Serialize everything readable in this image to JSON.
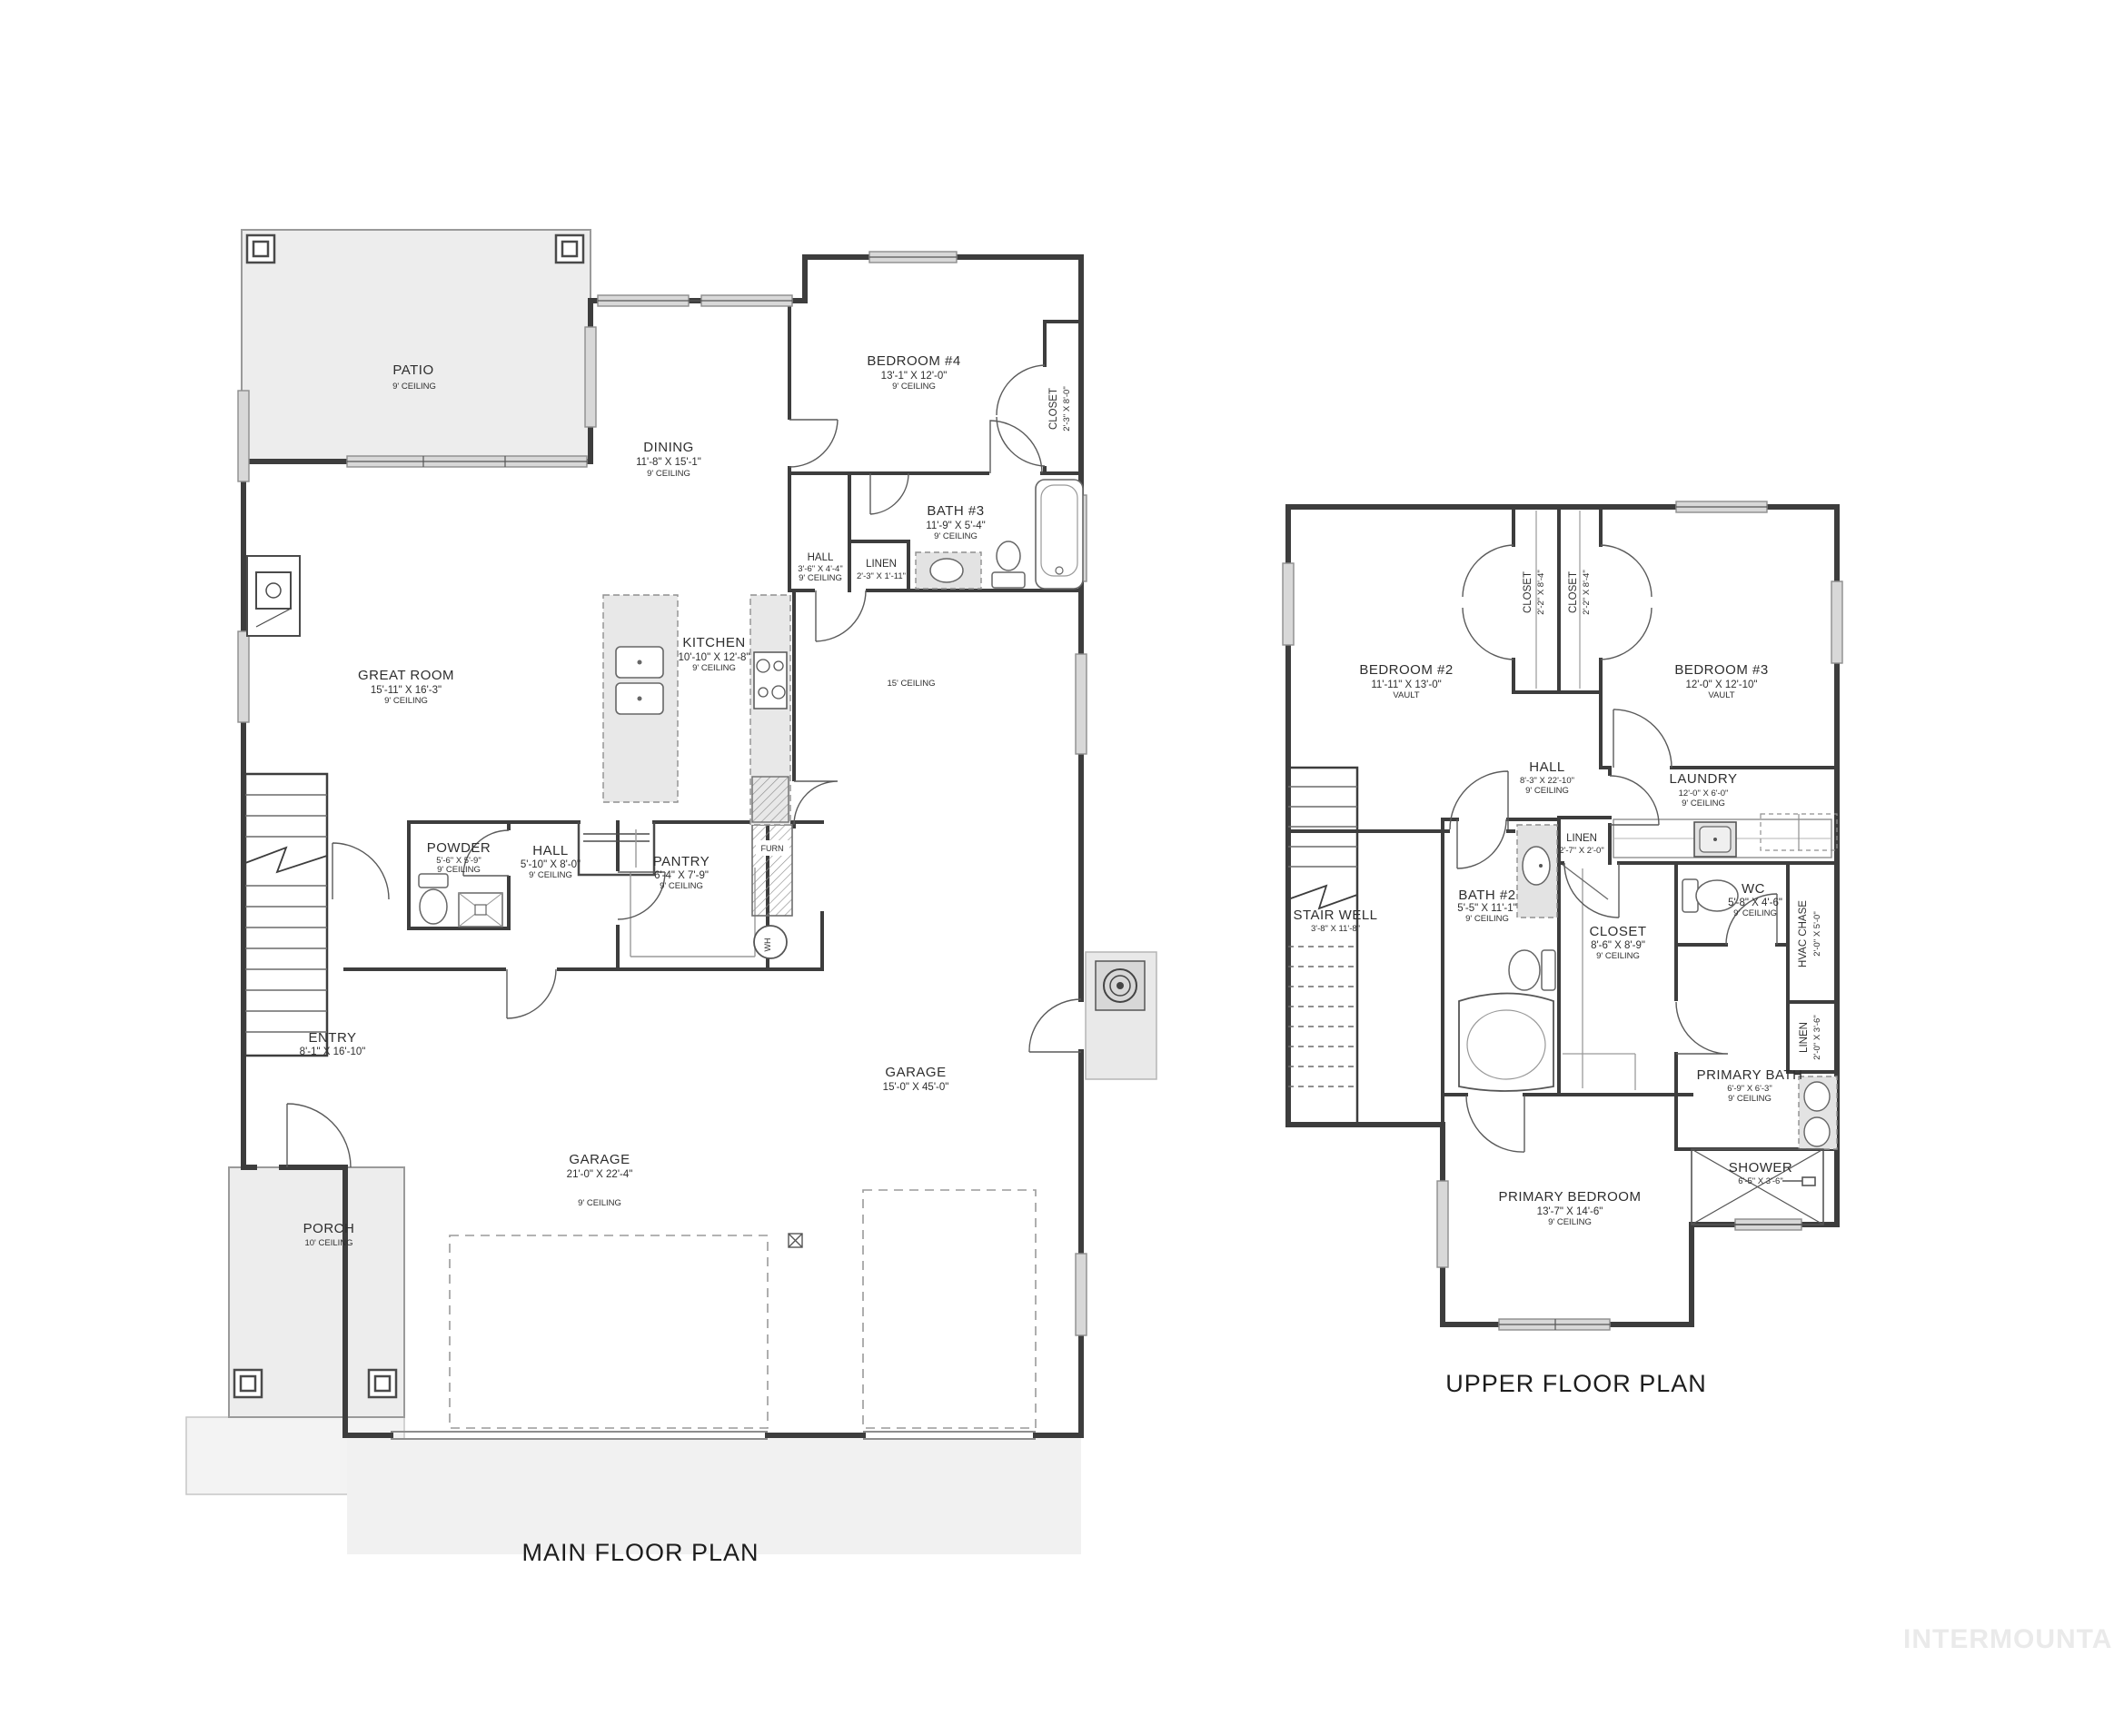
{
  "watermark": "INTERMOUNTAIN",
  "main": {
    "title": "MAIN FLOOR PLAN",
    "rooms": {
      "patio": {
        "name": "PATIO",
        "ceiling": "9' CEILING"
      },
      "dining": {
        "name": "DINING",
        "dims": "11'-8\" X 15'-1\"",
        "ceiling": "9' CEILING"
      },
      "bedroom4": {
        "name": "BEDROOM #4",
        "dims": "13'-1\" X 12'-0\"",
        "ceiling": "9' CEILING"
      },
      "closet4": {
        "name": "CLOSET",
        "dims": "2'-3\" X 8'-0\""
      },
      "bath3": {
        "name": "BATH #3",
        "dims": "11'-9\" X 5'-4\"",
        "ceiling": "9' CEILING"
      },
      "hall_bed": {
        "name": "HALL",
        "dims": "3'-6\" X 4'-4\"",
        "ceiling": "9' CEILING"
      },
      "linen": {
        "name": "LINEN",
        "dims": "2'-3\" X 1'-11\""
      },
      "great_room": {
        "name": "GREAT ROOM",
        "dims": "15'-11\" X 16'-3\"",
        "ceiling": "9' CEILING"
      },
      "kitchen": {
        "name": "KITCHEN",
        "dims": "10'-10\" X 12'-8\"",
        "ceiling": "9' CEILING"
      },
      "open_area": {
        "ceiling": "15' CEILING"
      },
      "powder": {
        "name": "POWDER",
        "dims": "5'-6\" X 5'-9\"",
        "ceiling": "9' CEILING"
      },
      "hall": {
        "name": "HALL",
        "dims": "5'-10\" X 8'-0\"",
        "ceiling": "9' CEILING"
      },
      "pantry": {
        "name": "PANTRY",
        "dims": "6'-4\" X 7'-9\"",
        "ceiling": "9' CEILING"
      },
      "furnace": {
        "name": "FURN"
      },
      "water_heater": {
        "name": "WH"
      },
      "entry": {
        "name": "ENTRY",
        "dims": "8'-1\" X 16'-10\""
      },
      "garage": {
        "name": "GARAGE",
        "dims": "21'-0\" X 22'-4\"",
        "ceiling": "9' CEILING"
      },
      "rv_garage": {
        "name": "GARAGE",
        "dims": "15'-0\" X 45'-0\""
      },
      "porch": {
        "name": "PORCH",
        "ceiling": "10' CEILING"
      }
    }
  },
  "upper": {
    "title": "UPPER FLOOR PLAN",
    "rooms": {
      "bedroom2": {
        "name": "BEDROOM #2",
        "dims": "11'-11\" X 13'-0\"",
        "ceiling": "VAULT"
      },
      "closet2": {
        "name": "CLOSET",
        "dims": "2'-2\" X 8'-4\""
      },
      "closet3": {
        "name": "CLOSET",
        "dims": "2'-2\" X 8'-4\""
      },
      "bedroom3": {
        "name": "BEDROOM #3",
        "dims": "12'-0\" X 12'-10\"",
        "ceiling": "VAULT"
      },
      "hall": {
        "name": "HALL",
        "dims": "8'-3\" X 22'-10\"",
        "ceiling": "9' CEILING"
      },
      "laundry": {
        "name": "LAUNDRY",
        "dims": "12'-0\" X 6'-0\"",
        "ceiling": "9' CEILING"
      },
      "linen_hall": {
        "name": "LINEN",
        "dims": "2'-7\" X 2'-0\""
      },
      "stair_well": {
        "name": "STAIR WELL",
        "dims": "3'-8\" X 11'-8\""
      },
      "bath2": {
        "name": "BATH #2",
        "dims": "5'-5\" X 11'-1\"",
        "ceiling": "9' CEILING"
      },
      "closet_walkin": {
        "name": "CLOSET",
        "dims": "8'-6\" X 8'-9\"",
        "ceiling": "9' CEILING"
      },
      "wc": {
        "name": "WC",
        "dims": "5'-8\" X 4'-6\"",
        "ceiling": "9' CEILING"
      },
      "hvac_chase": {
        "name": "HVAC CHASE",
        "dims": "2'-0\" X 5'-0\""
      },
      "linen_bath": {
        "name": "LINEN",
        "dims": "2'-0\" X 3'-6\""
      },
      "primary_bath": {
        "name": "PRIMARY BATH",
        "dims": "6'-9\" X 6'-3\"",
        "ceiling": "9' CEILING"
      },
      "shower": {
        "name": "SHOWER",
        "dims": "6'-5\" X 3'-6\""
      },
      "primary_bedroom": {
        "name": "PRIMARY BEDROOM",
        "dims": "13'-7\" X 14'-6\"",
        "ceiling": "9' CEILING"
      }
    }
  }
}
